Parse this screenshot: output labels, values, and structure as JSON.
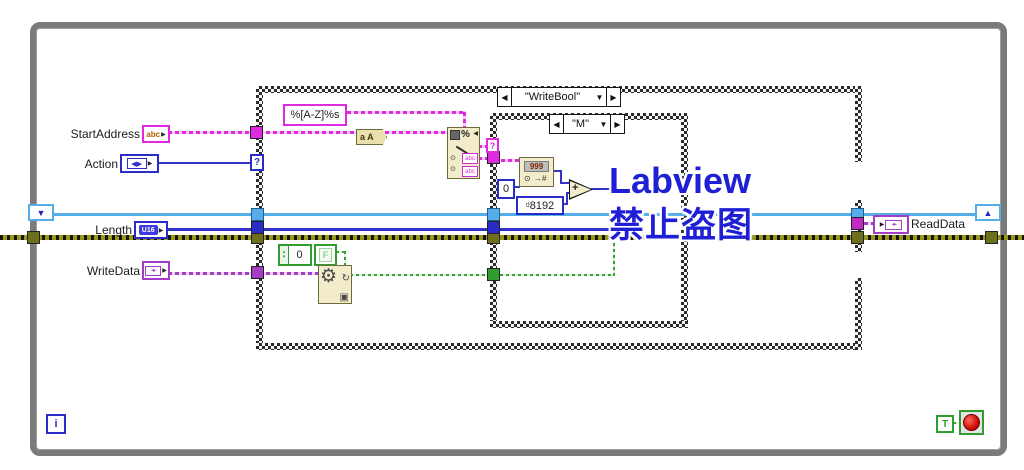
{
  "watermark": {
    "line1": "Labview",
    "line2": "禁止盗图",
    "color": "#1F1FD6"
  },
  "loop": {
    "iteration": "i"
  },
  "controls": {
    "start_address": {
      "label": "StartAddress",
      "glyph": "abc"
    },
    "action": {
      "label": "Action",
      "glyph": "◀▶"
    },
    "length": {
      "label": "Length",
      "glyph": "U16"
    },
    "write_data": {
      "label": "WriteData",
      "glyph": "-●-"
    }
  },
  "indicators": {
    "read_data": {
      "label": "ReadData",
      "glyph": "-●-"
    }
  },
  "cases": {
    "outer": {
      "selector": "\"WriteBool\""
    },
    "inner": {
      "selector": "\"M\""
    }
  },
  "constants": {
    "format_string": "%[A-Z]%s",
    "zero": "0",
    "offset_radix": "d",
    "offset": "8192",
    "enum_zero": "0",
    "false": "F",
    "true": "T"
  },
  "functions": {
    "to_upper": "a A",
    "digits": "999",
    "add": "+"
  },
  "glyphs": {
    "la": "◀",
    "ra": "▶",
    "da": "▼",
    "ua": "▲",
    "q": "?",
    "pct": "%",
    "gear": "⚙",
    "rot": "↻",
    "win": "▣",
    "tgt": "⊙",
    "tonum": "→#",
    "su": "▴",
    "sd": "▾",
    "abc": "abc"
  },
  "colors": {
    "string_pink": "#E02AE0",
    "numeric_blue": "#2B2BC8",
    "reference_sky": "#55AEE8",
    "error_olive": "#6E6E1E",
    "boolean_green": "#2F9E2F",
    "cluster_purple": "#A43CC4",
    "loop_gray": "#7B7B7B",
    "watermark_blue": "#1F1FD6"
  }
}
